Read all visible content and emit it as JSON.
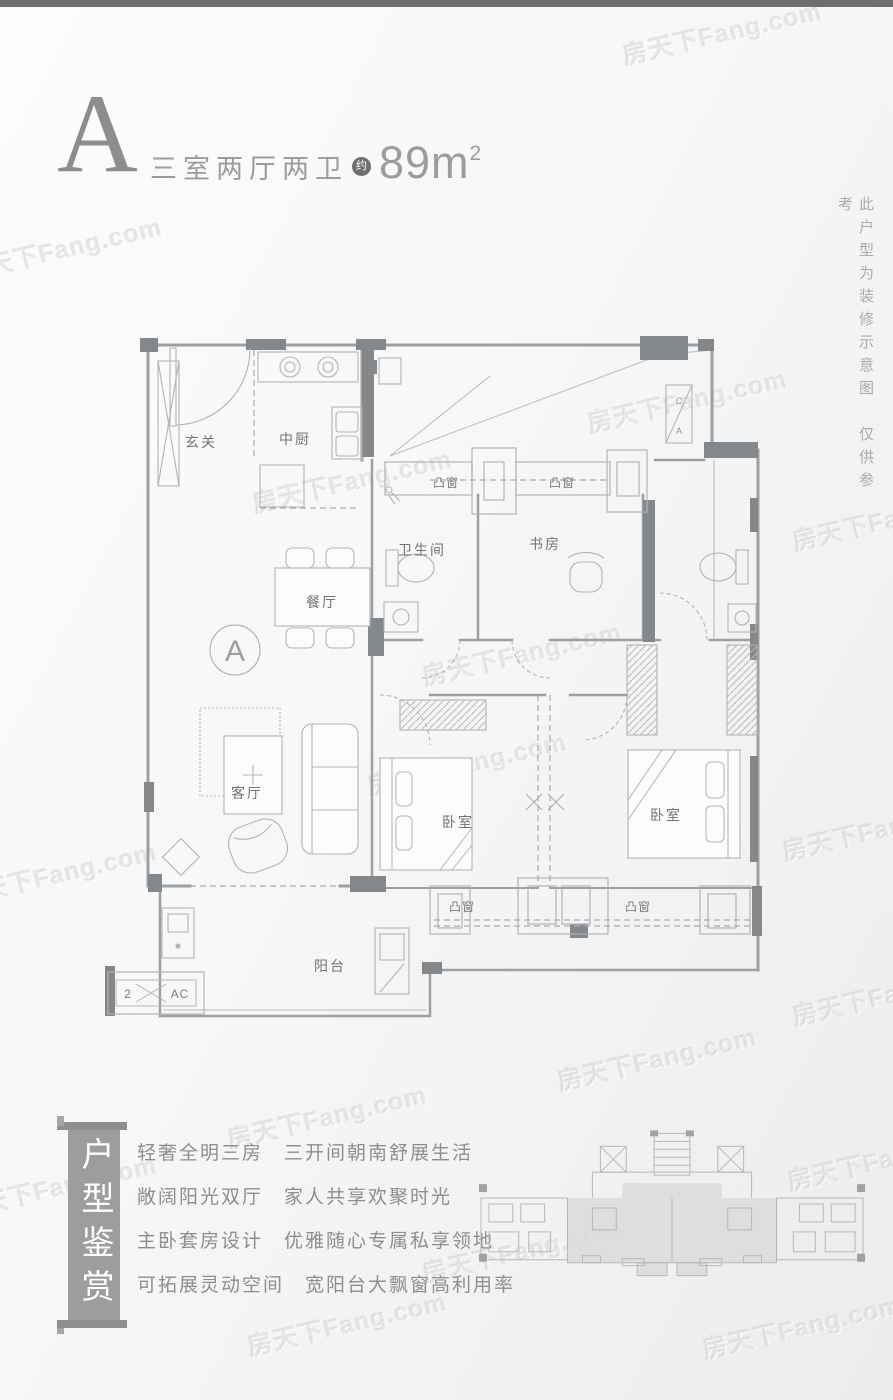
{
  "colors": {
    "top_bar": "#6e6e6e",
    "banner_bg": "#9d9d9d",
    "badge_bg": "#6f6f6f",
    "title_text": "#9c9c9c",
    "plan_line": "#9aa0a4",
    "plan_dark_block": "#85888b",
    "keyplan_shade": "#dbdbdb"
  },
  "watermark": {
    "text": "房天下Fang.com"
  },
  "header": {
    "plan_letter": "A",
    "title": "三室两厅两卫",
    "approx_badge": "约",
    "area_value": "89m",
    "area_sup": "2"
  },
  "side_note": {
    "text": "此户型为装修示意图　仅供参考"
  },
  "floor_plan": {
    "unit_marker": "A",
    "labels": {
      "entry": "玄关",
      "kitchen": "中厨",
      "dining": "餐厅",
      "living": "客厅",
      "bath": "卫生间",
      "study": "书房",
      "bedroom": "卧室",
      "balcony": "阳台",
      "bay_window": "凸窗",
      "ac_box_top": "C",
      "ac_box_bottom": "A",
      "ac_platform_left": "2",
      "ac_platform_right": "AC"
    }
  },
  "features": {
    "banner_vertical": "户型鉴赏",
    "lines": [
      "轻奢全明三房　三开间朝南舒展生活",
      "敞阔阳光双厅　家人共享欢聚时光",
      "主卧套房设计　优雅随心专属私享领地",
      "可拓展灵动空间　宽阳台大飘窗高利用率"
    ]
  }
}
